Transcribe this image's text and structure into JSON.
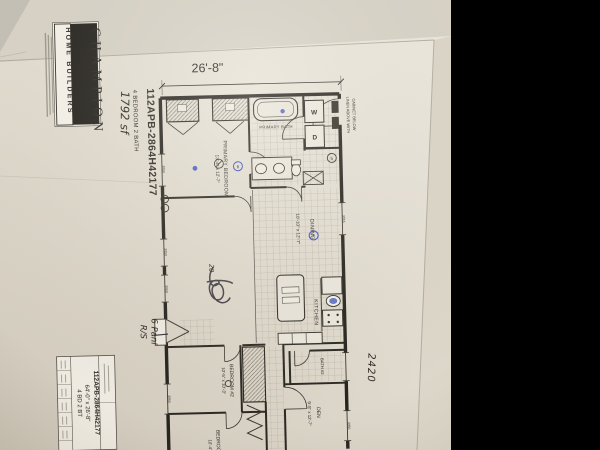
{
  "photo": {
    "paper_color": "#e7e2d8",
    "letterbox_color": "#000000",
    "ink_blue": "#3b52bd",
    "pen_black": "#34313a"
  },
  "logo": {
    "brand": "CHAMPION",
    "tagline": "HOME BUILDERS"
  },
  "header": {
    "width_dim": "26'-8\"",
    "model": "112APB-2864H42177",
    "spec": "4 BEDROOM 2 BATH",
    "sqft_note": "1792 sf"
  },
  "rooms": {
    "primary_bedroom": {
      "name": "PRIMARY BEDROOM",
      "dims": "13'-4\" x 12'-7\""
    },
    "primary_bath": {
      "name": "PRIMARY BATH"
    },
    "dining": {
      "name": "DINING",
      "dims": "10'-10\" x 12'-7\""
    },
    "kitchen": {
      "name": "KITCHEN"
    },
    "bath2": {
      "name": "BATH #2"
    },
    "bedroom2": {
      "name": "BEDROOM #2",
      "dims": "10'-5\" x 10'-3\""
    },
    "den": {
      "name": "DEN",
      "dims": "9'-5\" x 12'-7\""
    },
    "bedroom3": {
      "name": "BEDROOM",
      "dims": "10'-4\""
    }
  },
  "fixtures": {
    "washer": "W",
    "dryer": "D"
  },
  "notes": {
    "linen1": "LINEN ABOVE WITH",
    "linen2": "CABINET BELOW",
    "win_3050": "3050",
    "win_3016": "3016"
  },
  "handwritten": {
    "door_note_1": "6 Panl",
    "door_note_2": "R/S",
    "blue_window_code": "2420",
    "scribble": "20"
  },
  "markers": {
    "m5": "5",
    "m6": "6"
  },
  "title_block": {
    "model": "112APB-2864H42177",
    "size": "64'-0\" x 26'-8\"",
    "spec": "4 BD 2 BT"
  }
}
